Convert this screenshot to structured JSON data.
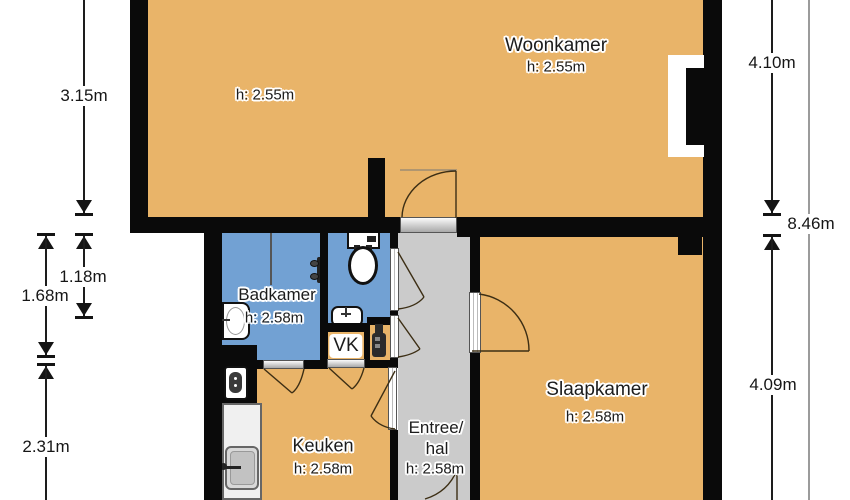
{
  "floorplan": {
    "title": "Apartment floor plan (Dutch labels)",
    "rooms": {
      "woonkamer": {
        "label": "Woonkamer",
        "ceiling_height": "h: 2.55m",
        "ceiling_height_left": "h: 2.55m"
      },
      "badkamer": {
        "label": "Badkamer",
        "ceiling_height": "h: 2.58m"
      },
      "vk": {
        "label": "VK"
      },
      "keuken": {
        "label": "Keuken",
        "ceiling_height": "h: 2.58m"
      },
      "entree": {
        "label_line1": "Entree/",
        "label_line2": "hal",
        "ceiling_height": "h: 2.58m"
      },
      "slaapkamer": {
        "label": "Slaapkamer",
        "ceiling_height": "h: 2.58m"
      }
    },
    "dimensions": {
      "left_top": "3.15m",
      "left_inner_narrow": "1.18m",
      "left_inner_wide": "1.68m",
      "left_bottom": "2.31m",
      "right_top": "4.10m",
      "right_total": "8.46m",
      "right_bottom": "4.09m"
    },
    "colors": {
      "room": "#e9b469",
      "wet": "#72a1d3",
      "hall": "#cbcbcb",
      "wall": "#0a0a0a"
    },
    "fixtures": [
      "toilet",
      "hand-basin",
      "washbasin",
      "shower-mixer",
      "boiler",
      "geyser",
      "kitchen-counter",
      "kitchen-sink",
      "chimney-niche"
    ]
  }
}
